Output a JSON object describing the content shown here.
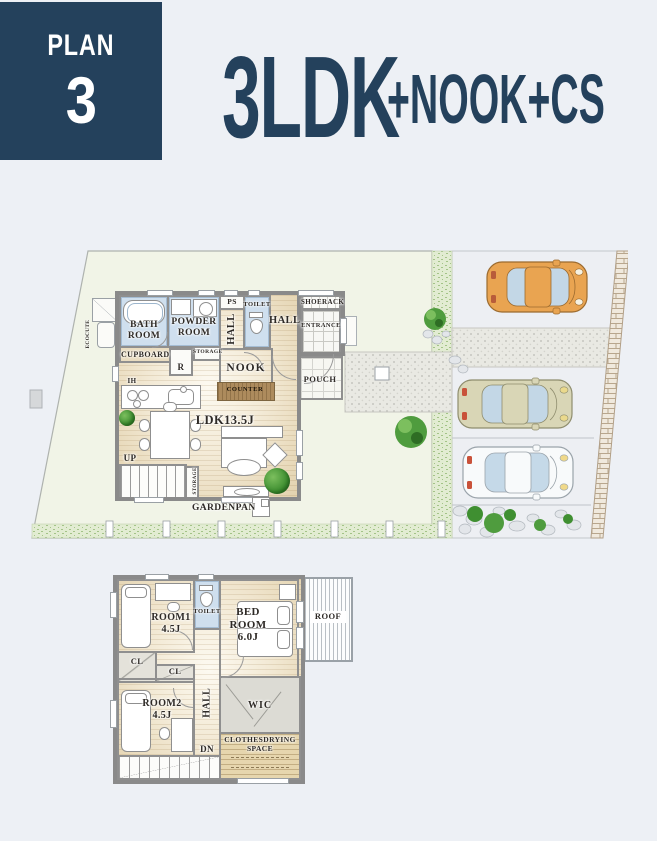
{
  "header": {
    "plan_label": "PLAN",
    "plan_number": "3",
    "title_main": "3LDK",
    "title_suffix": "+NOOK+CS"
  },
  "colors": {
    "navy": "#24415c",
    "yard_green": "#f1f4e7",
    "wall_gray": "#8a8a8a",
    "wet_room_blue": "#cfdfee",
    "counter_brown": "#ad8b5d",
    "car_orange": "#e9a451",
    "car_beige": "#d9d6b6",
    "car_white": "#f8fafb"
  },
  "floor1": {
    "ecocute": "ECOCUTE",
    "bath_room": "BATH ROOM",
    "powder_room": "POWDER ROOM",
    "ps": "PS",
    "hall_side": "HALL",
    "toilet": "TOILET",
    "hall": "HALL",
    "shoerack": "SHOERACK",
    "entrance": "ENTRANCE",
    "cupboard": "CUPBOARD",
    "refrigerator": "R",
    "storage_pantry": "STORAGE",
    "nook": "NOOK",
    "counter": "COUNTER",
    "ih": "IH",
    "ldk": "LDK13.5J",
    "up": "UP",
    "storage_under_stairs": "STORAGE",
    "gardenpan": "GARDENPAN",
    "pouch": "POUCH"
  },
  "floor2": {
    "room1": "ROOM1 4.5J",
    "toilet": "TOILET",
    "bed_room": "BED ROOM 6.0J",
    "roof": "ROOF",
    "closet1": "CL",
    "closet2": "CL",
    "hall": "HALL",
    "room2": "ROOM2 4.5J",
    "wic": "WIC",
    "clothes_drying": "CLOTHESDRYING SPACE",
    "dn": "DN"
  }
}
